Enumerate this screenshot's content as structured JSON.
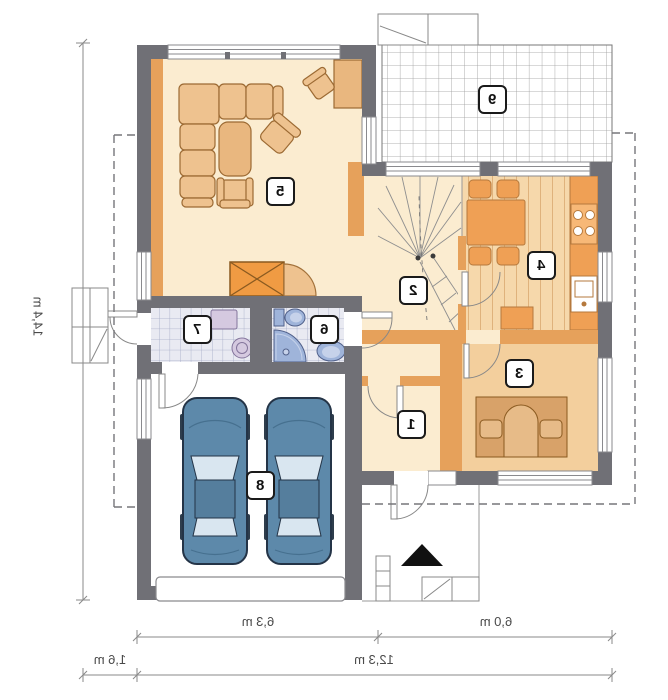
{
  "plan": {
    "type": "house-first-floor-plan-mirrored",
    "room_numbers": {
      "vestibule": "1",
      "hall": "2",
      "office": "3",
      "kitchen": "4",
      "living_room": "5",
      "bathroom": "6",
      "laundry": "7",
      "garage": "8",
      "terrace": "9"
    },
    "dimensions": {
      "total_height": "14,4 m",
      "garage_width": "6,3 m",
      "right_width": "6,0 m",
      "total_width": "12,3 m",
      "left_offset": "1,6 m"
    },
    "colors": {
      "wall": "#707076",
      "partition": "#e6a15b",
      "floor_cream": "#fbecd0",
      "floor_wood": "#f6d8ab",
      "floor_tan": "#f3cf9d",
      "tile": "#e9eaf2",
      "sanitary_blue": "#9fb4da",
      "car_blue": "#5d89aa",
      "furniture_tan": "#eec28f",
      "accent_orange": "#f09b43"
    }
  }
}
